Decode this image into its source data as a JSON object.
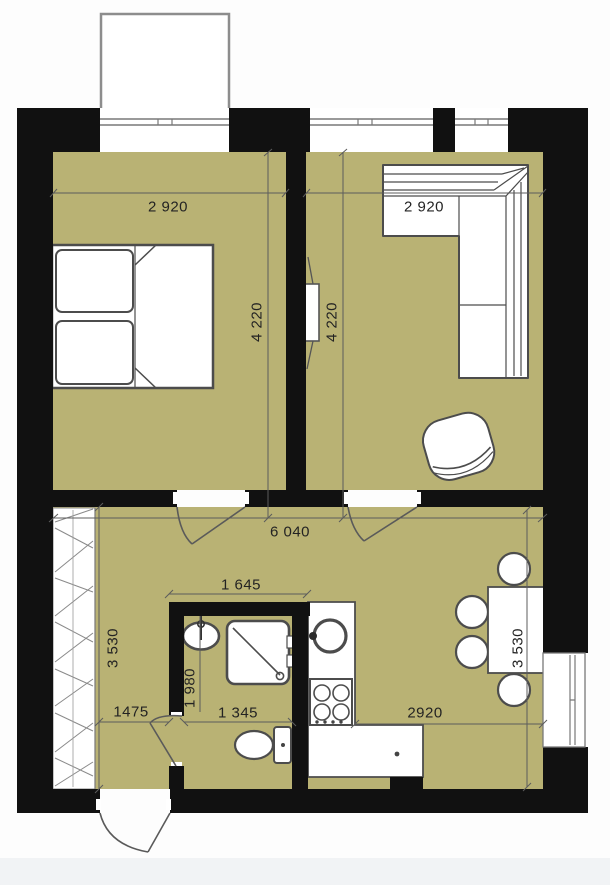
{
  "plan": {
    "title": "one-bedroom-apartment-floor-plan",
    "floor_color": "#b9b274",
    "wall_color": "#111111",
    "dimensions": {
      "bedroom_width": "2 920",
      "living_width": "2 920",
      "bedroom_depth": "4 220",
      "living_depth": "4 220",
      "total_width": "6 040",
      "hall_depth": "3 530",
      "kitchen_depth": "3 530",
      "kitchen_width": "2920",
      "bathroom_width": "1 645",
      "bathroom_depth": "1 980",
      "bathroom_inner_width": "1 345",
      "hall_passage_width": "1475"
    },
    "furniture": [
      "double-bed",
      "corner-sofa",
      "pouf-chair",
      "dining-table",
      "chairs",
      "wardrobe",
      "kitchen-sink",
      "stove",
      "counter",
      "washbasin",
      "shower",
      "toilet",
      "radiator"
    ]
  }
}
